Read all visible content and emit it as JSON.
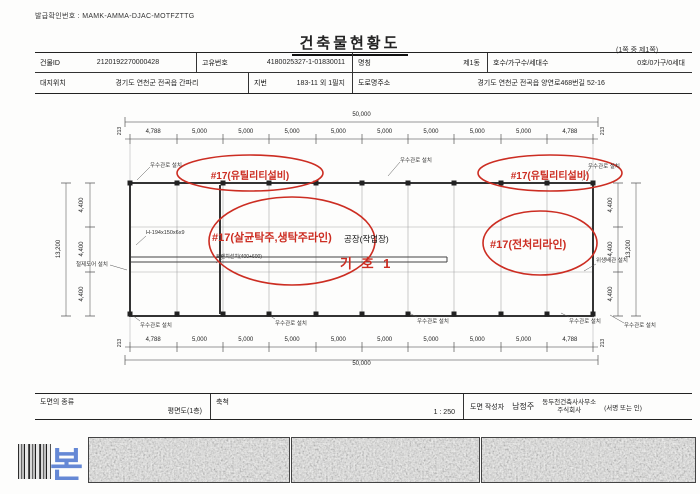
{
  "header": {
    "issue_no_label": "발급확인번호 :",
    "issue_no": "MAMK-AMMA-DJAC-MOTFZTTG",
    "title": "건축물현황도",
    "page_note": "(1쪽 중 제1쪽)"
  },
  "info_table": {
    "building_id_label": "건물ID",
    "building_id": "2120192270000428",
    "unique_no_label": "고유번호",
    "unique_no": "4180025327-1-01830011",
    "name_label": "명칭",
    "name": "제1동",
    "units_label": "호수/가구수/세대수",
    "units": "0호/0가구/0세대",
    "site_label": "대지위치",
    "site": "경기도 연천군 전곡읍 간파리",
    "lot_label": "지번",
    "lot": "183-11 외 1필지",
    "road_label": "도로명주소",
    "road": "경기도 연천군 전곡읍 양연로468번길 52-16"
  },
  "drawing": {
    "dims": {
      "overall_w": "50,000",
      "overall_h": "13,200",
      "edge": "213",
      "top": [
        "4,788",
        "5,000",
        "5,000",
        "5,000",
        "5,000",
        "5,000",
        "5,000",
        "5,000",
        "5,000",
        "4,788"
      ],
      "bottom": [
        "4,788",
        "5,000",
        "5,000",
        "5,000",
        "5,000",
        "5,000",
        "5,000",
        "5,000",
        "5,000",
        "4,788"
      ],
      "left": [
        "4,400",
        "4,400",
        "4,400"
      ],
      "right": [
        "4,400",
        "4,400",
        "4,400"
      ]
    },
    "labels": {
      "downpipe": "우수관로 설치",
      "hbeam": "H-194x150x6x9",
      "door": "철제도어 설치",
      "sanitary": "위생배관 설치",
      "trench": "트렌치설치(400+600)"
    },
    "annotations": {
      "red1": "#17(유틸리티설비)",
      "red2": "#17(유틸리티설비)",
      "red3": "#17(살균탁주,생탁주라인)",
      "red4": "#17(전처리라인)",
      "red_code": "기 호 1",
      "factory": "공장(작업장)"
    },
    "red_color": "#cc2d22"
  },
  "footer": {
    "type_label": "도면의 종류",
    "type_value": "평면도(1층)",
    "scale_label": "축척",
    "scale_value": "1 : 250",
    "author_label": "도면 작성자",
    "author_name": "남정주",
    "office_line1": "동두천건축사사무소",
    "office_line2": "주식회사",
    "sign_note": "(서명 또는 인)"
  },
  "watermark": {
    "blue_char": "본"
  }
}
